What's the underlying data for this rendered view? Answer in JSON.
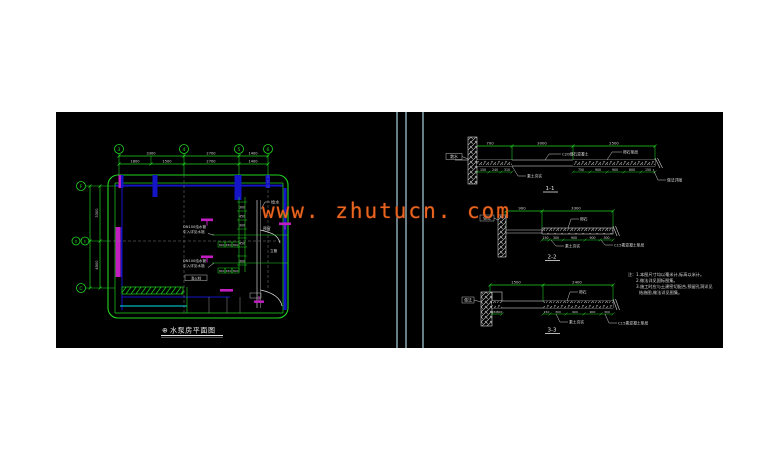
{
  "watermark": {
    "text": "www. zhutucn. com",
    "color": "#e8641f"
  },
  "plan": {
    "title_symbol": "⊕",
    "title": "水泵房平面图",
    "grid_top": [
      "3",
      "4",
      "5",
      "6"
    ],
    "grid_left_top": "F",
    "grid_left_mid_a": "D",
    "grid_left_mid_b": "E",
    "grid_left_bottom": "C",
    "dims_row1": [
      "3300",
      "2700",
      "1400"
    ],
    "dims_row2": [
      "1800",
      "1500",
      "2700",
      "1400"
    ],
    "dims_left": [
      "3300",
      "4500"
    ],
    "ladder_dims": [
      "300",
      "450",
      "300",
      "450",
      "300"
    ],
    "box_dims_1": [
      "300",
      "450",
      "300"
    ],
    "box_dims_2": [
      "300",
      "450",
      "300"
    ],
    "labels": {
      "inlet_top": "给水",
      "reserve": "预留",
      "pipe_label_1a": "DN100给水管",
      "pipe_label_1b": "引入详见水施",
      "pipe_label_2a": "DN100给水管",
      "pipe_label_2b": "引入详见水施",
      "riser": "立管",
      "hydrant": "消火栓"
    }
  },
  "sections": {
    "s1": {
      "title": "1-1",
      "dims_top": [
        "700",
        "3000",
        "2500"
      ],
      "dims_below_left": [
        "150",
        "240",
        "310"
      ],
      "dims_below_right": [
        "750",
        "900",
        "900",
        "600",
        "150"
      ],
      "label_left": "散水",
      "label_top1": "C20细石混凝土",
      "label_top2": "卵石垫层",
      "label_bottom1": "素土夯实",
      "label_bottom2": "做法详图"
    },
    "s2": {
      "title": "2-2",
      "dims_top": [
        "900",
        "3300"
      ],
      "dims_below": [
        "150",
        "300",
        "900",
        "900",
        "300"
      ],
      "label_left": "做法",
      "label_top": "卵石",
      "label_bottom1": "素土夯实",
      "label_bottom2": "C15素混凝土垫层"
    },
    "s3": {
      "title": "3-3",
      "dims_top": [
        "1500",
        "2400"
      ],
      "dims_below_left": [
        "150",
        "300"
      ],
      "dims_below_right": [
        "150",
        "300",
        "900",
        "900",
        "300"
      ],
      "label_left": "做法",
      "label_top": "卵石",
      "label_bottom1": "素土夯实",
      "label_bottom2": "C15素混凝土垫层"
    }
  },
  "notes": {
    "prefix": "注:",
    "lines": [
      "1.本图尺寸均以毫米计,标高以米计。",
      "2.做法详见国标图集。",
      "3.施工时应与土建密切配合,预留孔洞详见",
      "结施图,做法详见图集。"
    ]
  }
}
